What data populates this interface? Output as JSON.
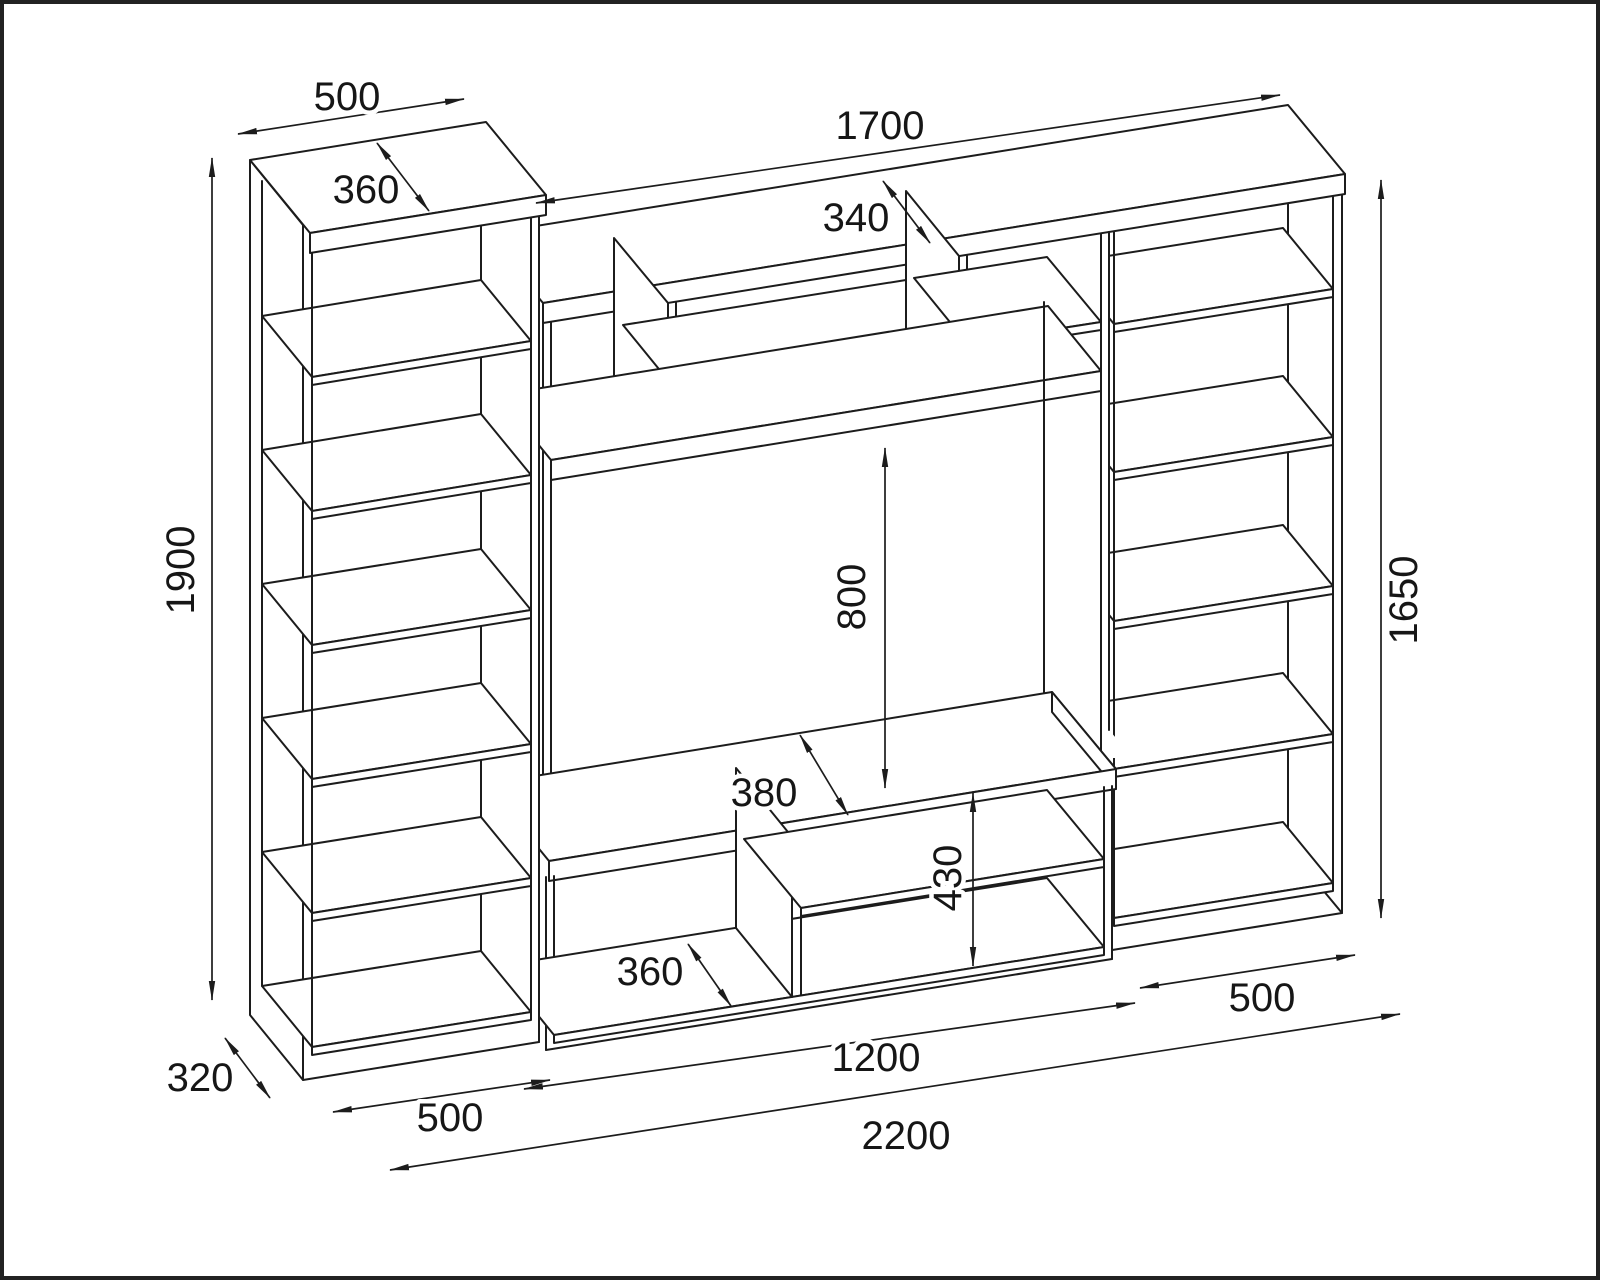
{
  "drawing": {
    "type": "furniture-dimension-drawing",
    "subject": "tv-wall-unit-with-bookcases",
    "units": "mm",
    "background_color": "#ffffff",
    "line_color": "#1c1c1c",
    "border_color": "#222222",
    "dimensions": {
      "left_top_width": "500",
      "left_top_depth": "360",
      "left_height": "1900",
      "top_width": "1700",
      "top_depth": "340",
      "niche_height": "800",
      "right_height": "1650",
      "bench_depth": "380",
      "base_height": "430",
      "base_depth": "360",
      "center_width": "1200",
      "total_width": "2200",
      "left_base_depth": "320",
      "left_base_width": "500",
      "right_base_width": "500"
    }
  }
}
